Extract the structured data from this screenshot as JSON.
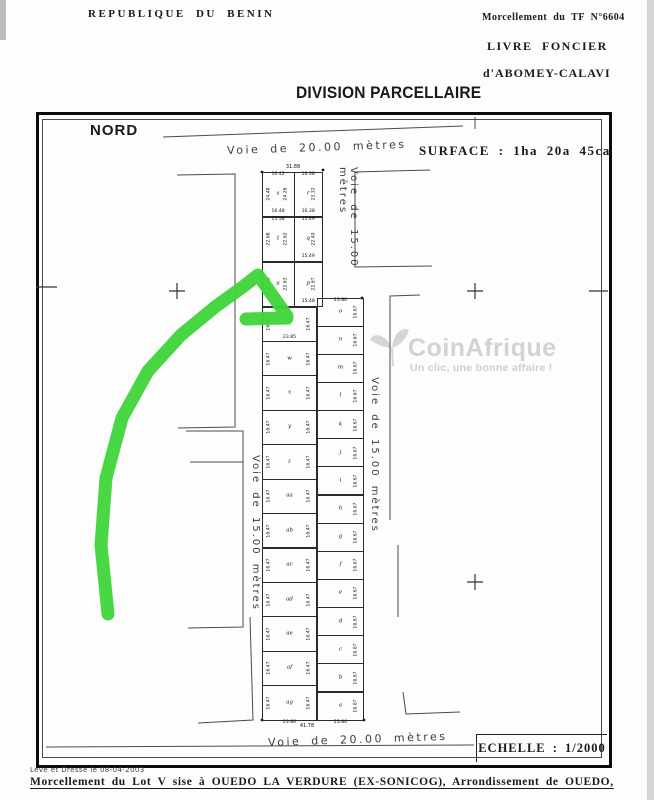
{
  "header": {
    "republic": "REPUBLIQUE DU BENIN",
    "morcellement_ref": "Morcellement du TF N°6604",
    "livre_foncier": "LIVRE FONCIER",
    "livre_location": "d'ABOMEY-CALAVI",
    "title": "DIVISION PARCELLAIRE"
  },
  "plan": {
    "north_label": "NORD",
    "surface_label": "SURFACE : 1ha 20a 45ca",
    "scale_label": "ECHELLE : 1/2000",
    "roads": {
      "top": "Voie de 20.00 mètres",
      "bottom": "Voie de 20.00 mètres",
      "right_upper": "Voie de 15.00 mètres",
      "right_lower": "Voie de 15.00 mètres",
      "left": "Voie de 15.00 mètres"
    },
    "strip": {
      "total_width_top": "31.88",
      "total_width_bottom": "41.78",
      "narrow_rows": [
        {
          "cells": [
            {
              "letter": "s",
              "top": "16.42",
              "side_left": "24.48",
              "side_right": "24.26",
              "bottom": "16.48"
            },
            {
              "letter": "r",
              "top": "16.38",
              "side_right": "23.32",
              "bottom": "16.38"
            }
          ]
        },
        {
          "cells": [
            {
              "letter": "t",
              "top": "15.58",
              "side_left": "22.68",
              "side_right": "22.62"
            },
            {
              "letter": "q",
              "top": "15.49",
              "side_right": "22.40",
              "bottom": "15.49"
            }
          ]
        },
        {
          "cells": [
            {
              "letter": "u",
              "side_left": "22.68",
              "side_right": "22.63"
            },
            {
              "letter": "p",
              "side_right": "22.67",
              "bottom": "15.48"
            }
          ]
        }
      ],
      "wide_left_col": {
        "letters": [
          "v",
          "w",
          "x",
          "y",
          "z",
          "aa",
          "ab",
          "ac",
          "ad",
          "ae",
          "af",
          "ag"
        ],
        "side_label": "16.47",
        "width_label": "23.85",
        "bottom_label": "23.86"
      },
      "wide_right_col": {
        "letters": [
          "o",
          "n",
          "m",
          "l",
          "k",
          "j",
          "i",
          "h",
          "g",
          "f",
          "e",
          "d",
          "c",
          "b",
          "a"
        ],
        "side_label": "16.67",
        "top_label": "23.86",
        "bottom_label": "23.86"
      }
    },
    "annotation_color": "#3fd63a"
  },
  "watermark": {
    "brand": "CoinAfrique",
    "tagline": "Un clic, une bonne affaire !"
  },
  "footer": {
    "survey_note": "Levé et Dressé le 08-04-2003",
    "caption": "Morcellement du Lot V sise à OUEDO LA VERDURE (EX-SONICOG), Arrondissement de OUEDO,"
  }
}
